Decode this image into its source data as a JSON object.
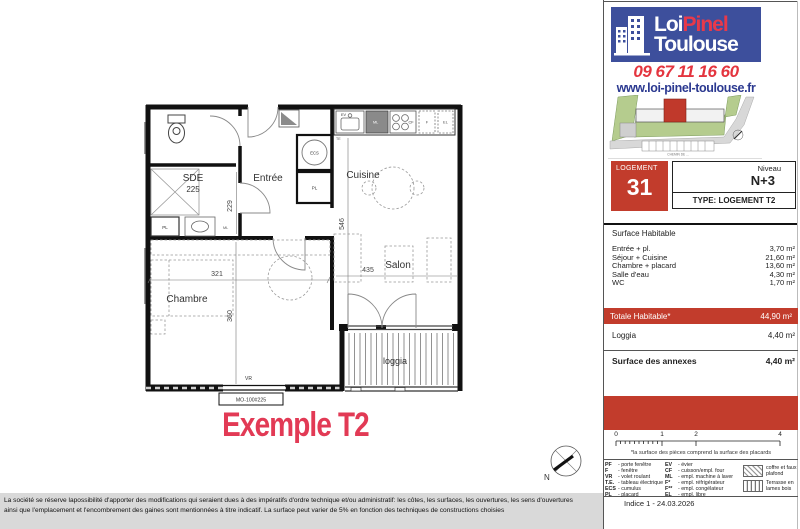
{
  "branding": {
    "logo_word1": "Loi",
    "logo_word2": "Pinel",
    "logo_word3": "Toulouse",
    "phone": "09 67 11 16 60",
    "website": "www.loi-pinel-toulouse.fr"
  },
  "sitemap": {
    "road_label": "CHEMIN DE ..."
  },
  "unit": {
    "label": "LOGEMENT",
    "number": "31",
    "level_label": "Niveau",
    "level_value": "N+3",
    "type_line": "TYPE:  LOGEMENT T2"
  },
  "surfaces": {
    "header": "Surface Habitable",
    "rows": [
      {
        "label": "Entrée + pl.",
        "value": "3,70 m²"
      },
      {
        "label": "Séjour + Cuisine",
        "value": "21,60 m²"
      },
      {
        "label": "Chambre + placard",
        "value": "13,60 m²"
      },
      {
        "label": "Salle d'eau",
        "value": "4,30 m²"
      },
      {
        "label": "WC",
        "value": "1,70 m²"
      }
    ],
    "total_label": "Totale Habitable*",
    "total_value": "44,90 m²",
    "loggia_label": "Loggia",
    "loggia_value": "4,40 m²",
    "annexes_label": "Surface des annexes",
    "annexes_value": "4,40 m²"
  },
  "scale": {
    "ticks": [
      "0",
      "1",
      "2",
      "4"
    ]
  },
  "footnote": "*la surface des pièces comprend la surface des placards",
  "legend": {
    "col1": [
      {
        "abbr": "PF",
        "desc": "- porte fenêtre"
      },
      {
        "abbr": "F",
        "desc": "- fenêtre"
      },
      {
        "abbr": "VR",
        "desc": "- volet roulant"
      },
      {
        "abbr": "T.E.",
        "desc": "- tableau électrique"
      },
      {
        "abbr": "ECS",
        "desc": "- cumulus"
      },
      {
        "abbr": "PL",
        "desc": "- placard"
      }
    ],
    "col2": [
      {
        "abbr": "EV",
        "desc": "- évier"
      },
      {
        "abbr": "CF",
        "desc": "- cuisson/empl. four"
      },
      {
        "abbr": "ML",
        "desc": "- empl. machine à laver"
      },
      {
        "abbr": "F*",
        "desc": "- empl. réfrigérateur"
      },
      {
        "abbr": "F**",
        "desc": "- empl. congélateur"
      },
      {
        "abbr": "EL",
        "desc": "- empl. libre"
      }
    ],
    "swatch_hatch": "coffre et faux plafond",
    "swatch_slats": "Terrasse en lames bois"
  },
  "indice": "Indice 1 - 24.03.2026",
  "plan": {
    "caption": "Exemple T2",
    "rooms": {
      "sde": "SDE",
      "sde_area": "225",
      "entree": "Entrée",
      "cuisine": "Cuisine",
      "salon": "Salon",
      "chambre": "Chambre",
      "loggia": "loggia"
    },
    "dims": {
      "d_sde": "229",
      "d_chambre_w": "321",
      "d_chambre_h": "360",
      "d_salon_w": "435",
      "d_salon_h": "546"
    },
    "tags": {
      "vr": "VR",
      "window_ref": "MO-100#225",
      "ecs": "ECS",
      "pl": "PL",
      "pl_sde": "PL",
      "ev": "EV",
      "ml": "ML",
      "ml_sde": "ML",
      "cf": "CF",
      "f": "F",
      "el": "EL",
      "te": "TE",
      "north": "N"
    }
  },
  "disclaimer": {
    "line1": "La société se réserve lapossibilité d'apporter des modifications qui seraient dues à des impératifs d'ordre technique et/ou administratif: les côtes, les surfaces, les ouvertures, les sens d'ouvertures",
    "line2": "ainsi que l'emplacement et l'encombrement des gaines sont mentionnées à titre indicatif. La surface peut varier de 5% en fonction des techniques de constructions choisies"
  },
  "colors": {
    "accent_red": "#c23c2c",
    "logo_blue": "#3d4f9c",
    "pinel_red": "#e8394a",
    "phone_red": "#e4353f",
    "link_blue": "#2b3990",
    "caption_pink": "#e23a55"
  }
}
